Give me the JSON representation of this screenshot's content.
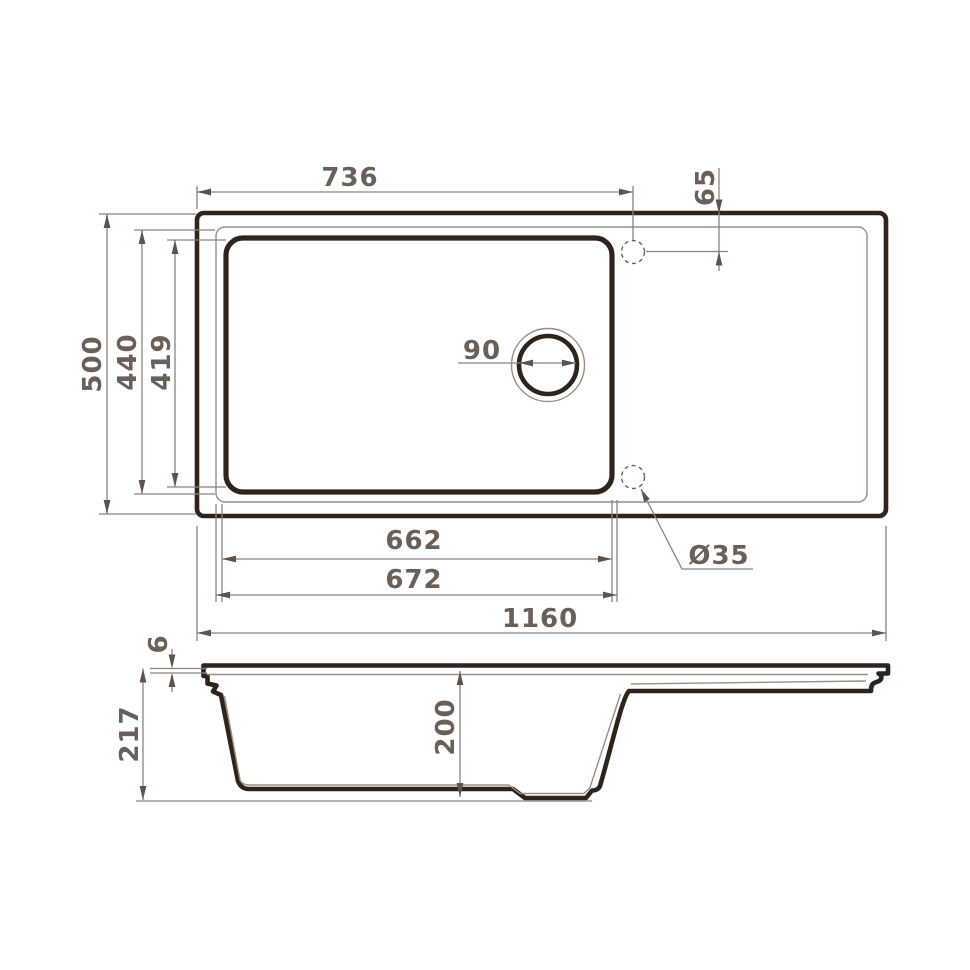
{
  "drawing": {
    "type": "technical-drawing",
    "subject": "Kitchen sink with drainboard - dimensioned plan view and section view",
    "units": "mm",
    "colors": {
      "outline": "#2f241c",
      "thin_line": "#9a8f85",
      "dimension_line": "#8d837b",
      "label_text": "#6b6057",
      "background": "#ffffff"
    },
    "views": {
      "top_view": "plan view of sink with bowl, drain hole and two tap holes",
      "side_view": "cross-section showing bowl depth and drainboard"
    },
    "dims": {
      "tap_offset_x": "736",
      "tap_offset_y": "65",
      "overall_depth": "500",
      "bowl_outer_depth": "440",
      "bowl_inner_depth": "419",
      "drain_diameter": "90",
      "bowl_inner_width": "662",
      "bowl_outer_width": "672",
      "overall_width": "1160",
      "tap_hole_diameter": "Ø35",
      "rim_thickness": "6",
      "overall_height": "217",
      "bowl_depth": "200"
    }
  }
}
